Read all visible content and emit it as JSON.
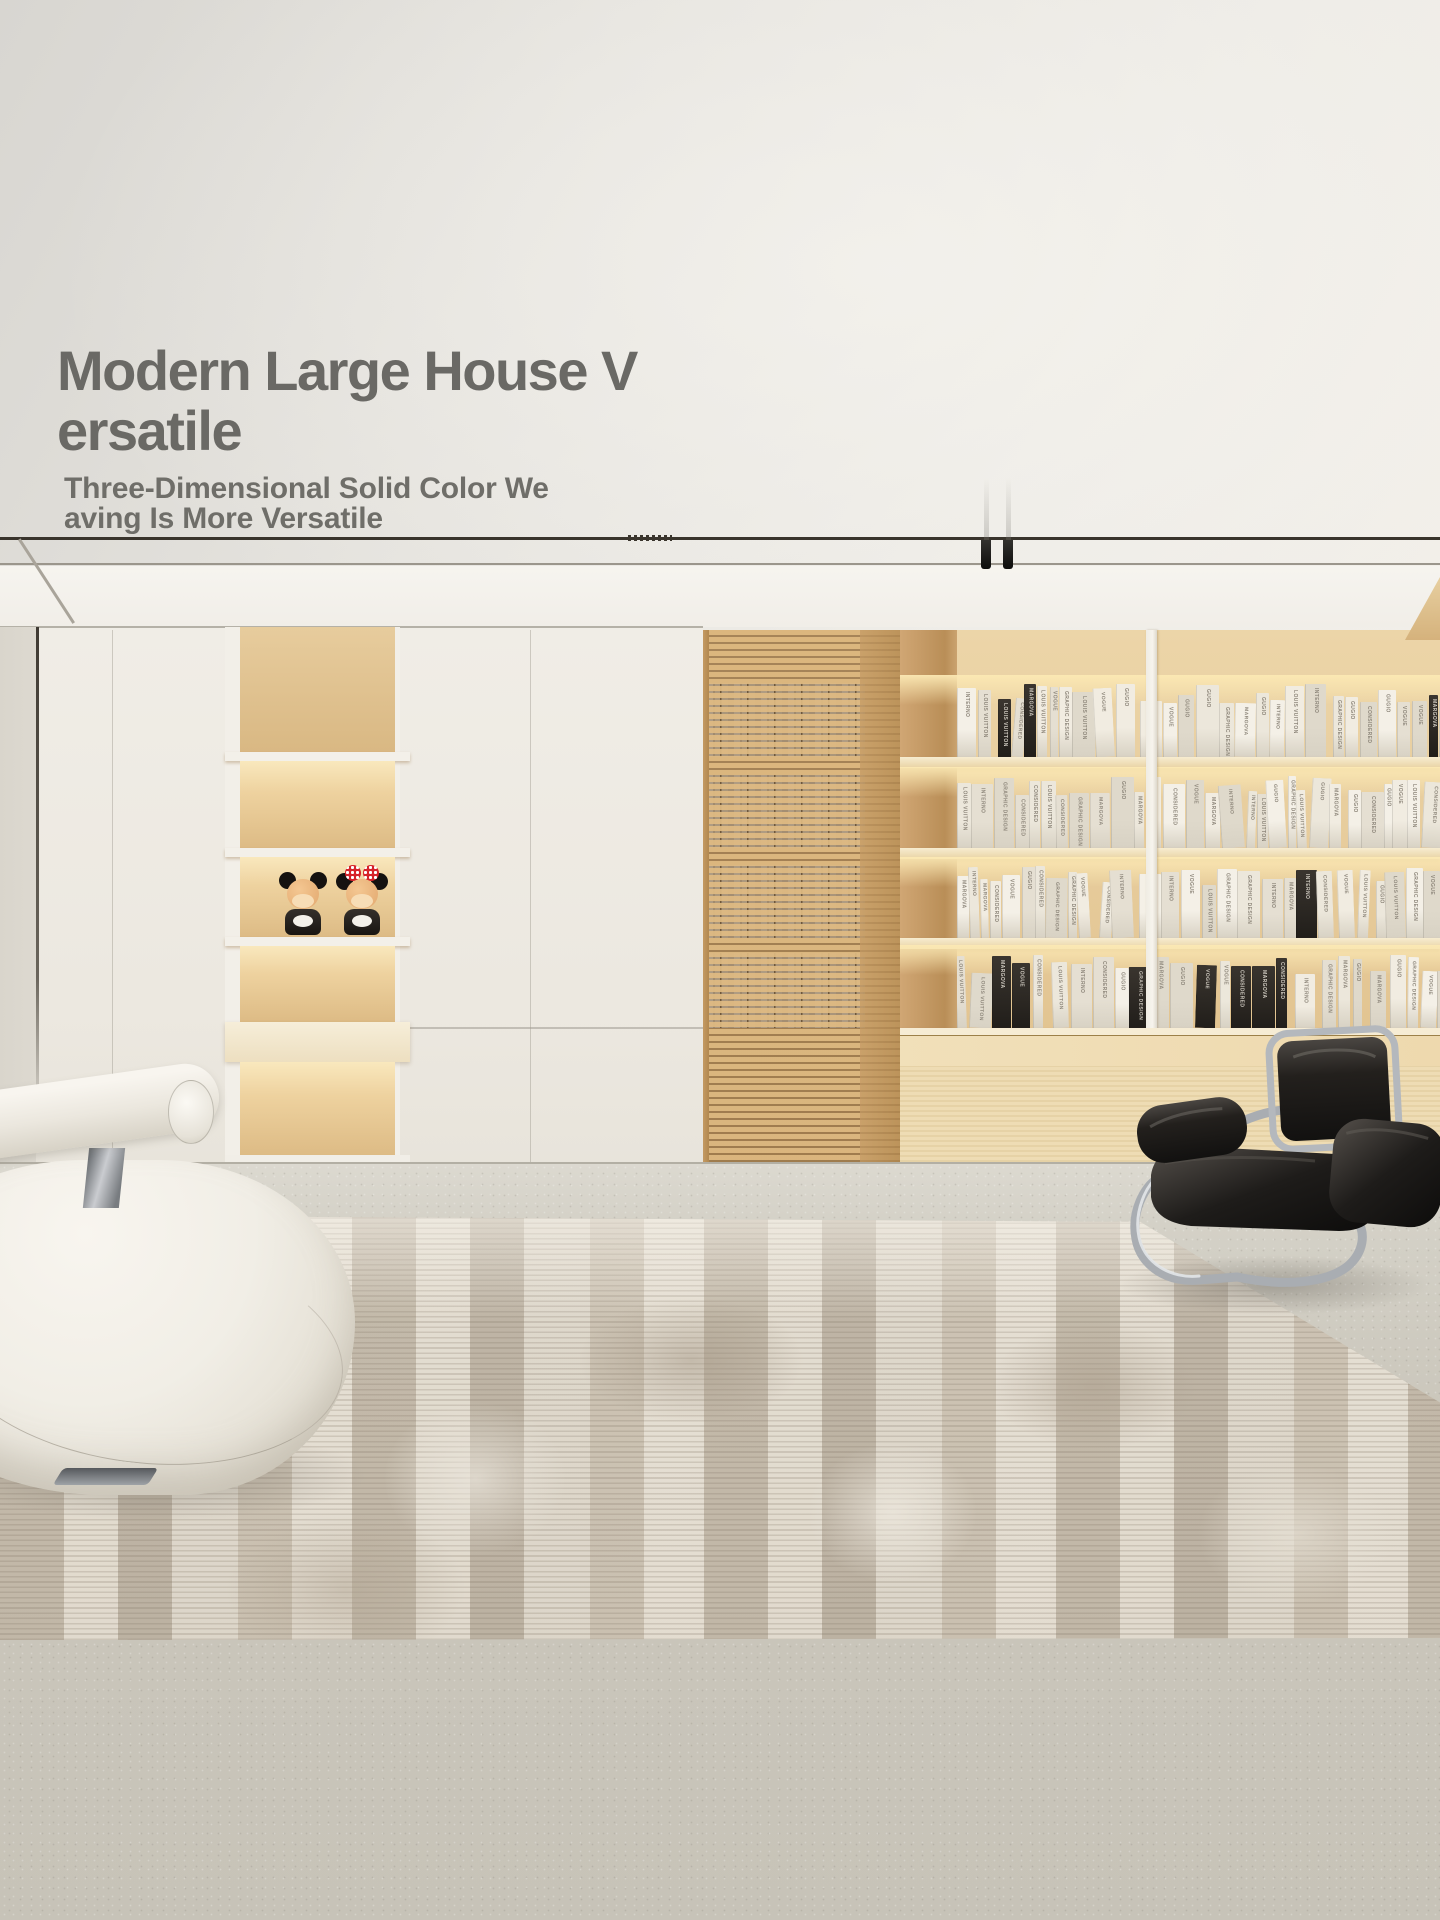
{
  "overlay": {
    "title_line1": "Modern Large House V",
    "title_line2": "ersatile",
    "subtitle_line1": "Three-Dimensional Solid Color We",
    "subtitle_line2": "aving Is More Versatile",
    "text_color": "#6a6965"
  },
  "bookshelf": {
    "spine_titles": [
      "MARGOVA",
      "GUGIO",
      "VOGUE",
      "GRAPHIC DESIGN",
      "CONSIDERED",
      "LOUIS VUITTON",
      "INTERNO"
    ],
    "rows": [
      {
        "top": 683,
        "height": 74
      },
      {
        "top": 775,
        "height": 73
      },
      {
        "top": 865,
        "height": 73
      },
      {
        "top": 953,
        "height": 75
      }
    ],
    "books_per_row": 40
  },
  "figurines": {
    "left": "Mickey Mouse",
    "right": "Minnie Mouse"
  },
  "palette": {
    "ceiling": "#eceae5",
    "wall_white": "#f1eee8",
    "cabinet_white": "#efece5",
    "wood_light": "#e2c493",
    "wood_deep": "#c89f66",
    "shelf_glow": "#f9e8bd",
    "floor": "#cbc7bc",
    "rug_base": "#d9d2c5",
    "rug_taupe": "#b0a492",
    "rug_cream": "#e8e2d6",
    "chair_black": "#1f1d1b",
    "chrome": "#b9bdc1",
    "sofa_white": "#f3f0e9",
    "bow_red": "#d6232a"
  }
}
